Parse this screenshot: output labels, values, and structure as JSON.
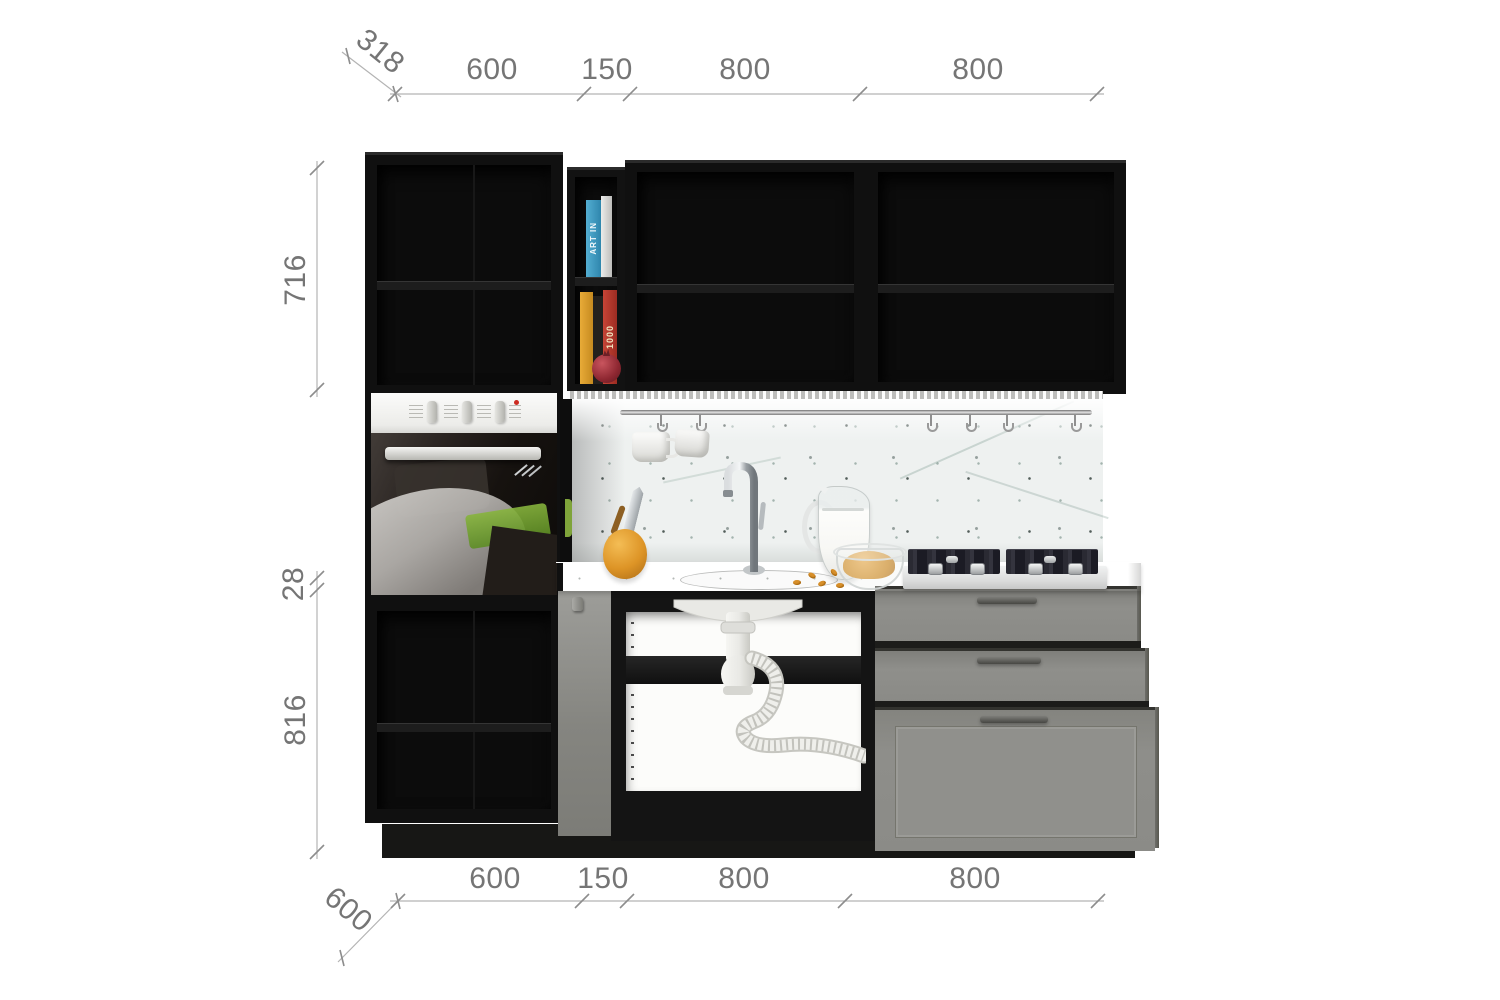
{
  "dimensions": {
    "top": {
      "depth": "318",
      "segments": [
        "600",
        "150",
        "800",
        "800"
      ]
    },
    "left": {
      "upper_cabinet_height": "716",
      "countertop_thickness": "28",
      "base_cabinet_height": "816"
    },
    "bottom": {
      "segments": [
        "600",
        "150",
        "800",
        "800"
      ],
      "depth": "600"
    }
  },
  "decor": {
    "book_spine_top": "ART IN",
    "book_spine_bottom": "1000"
  },
  "palette": {
    "background": "#ffffff",
    "dimension_line": "#b3b3b3",
    "dimension_text": "#757575",
    "cabinet_black": "#101010",
    "front_gray": "#8b8b87",
    "counter_white": "#f8f8f5",
    "backsplash_white": "#eef1f0",
    "handle_gray": "#4c4c48",
    "accent_orange": "#dd9426",
    "book_blue": "#3e9ec6",
    "book_red": "#b8372c",
    "reflection_green": "#6f9c2f",
    "led_white": "#ffffff"
  }
}
